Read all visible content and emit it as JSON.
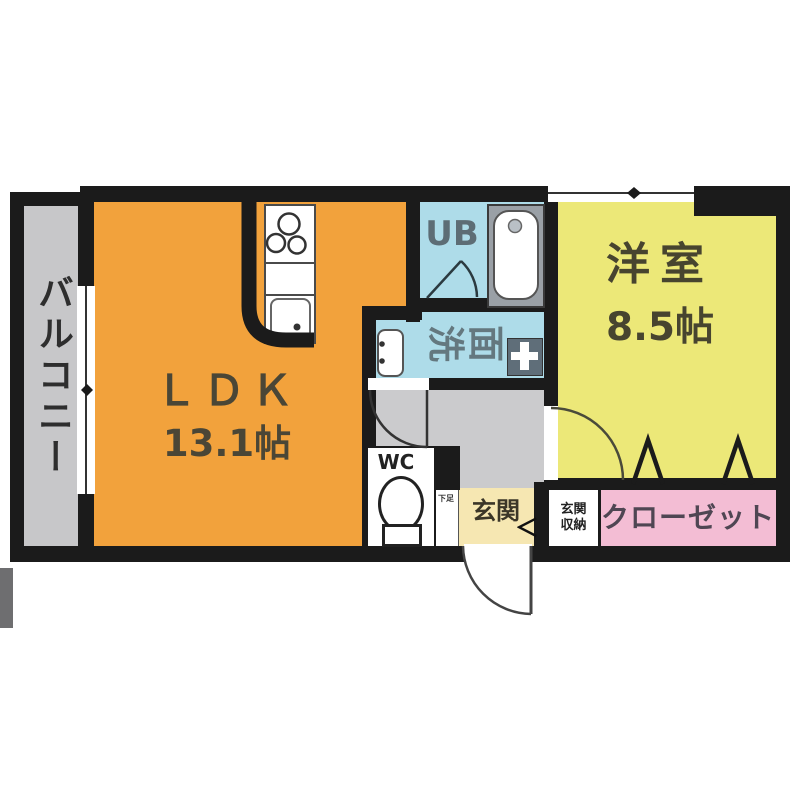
{
  "title": "apartment-floor-plan",
  "colors": {
    "wall": "#1b1b1b",
    "ldk": "#F2A23C",
    "western": "#ECE878",
    "bath": "#AEDCE9",
    "pink": "#F3BDD4",
    "cream": "#F6E7B2",
    "gray1": "#C7C7C9",
    "gray2": "#CBCBCD",
    "labeldark": "#4a4636",
    "labelgray": "#5d6d75"
  },
  "labels": {
    "balcony": "バルコニー",
    "ldk": "ＬＤＫ",
    "ldk_size": "13.1帖",
    "western_room": "洋室",
    "western_size": "8.5帖",
    "unit_bath": "UB",
    "washroom_char1": "洗",
    "washroom_char2": "面",
    "wc": "WC",
    "entrance": "玄関",
    "entrance_arrow": "＜",
    "entrance_storage_line1": "玄関",
    "entrance_storage_line2": "収納",
    "closet": "クローゼット",
    "shoe_note": "下足"
  }
}
